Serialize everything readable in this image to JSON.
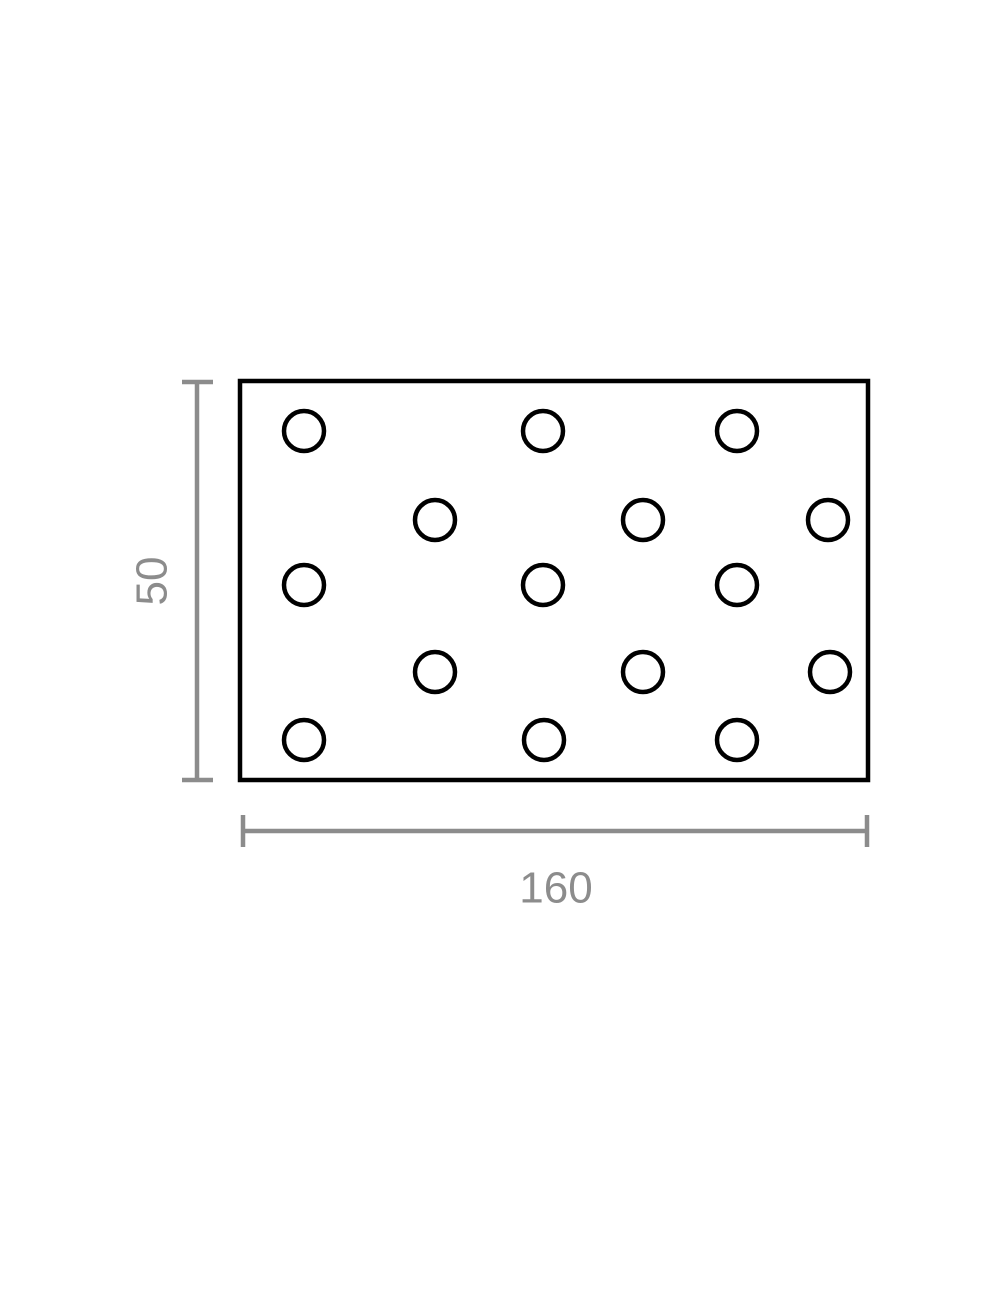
{
  "diagram": {
    "type": "technical-drawing",
    "subject": "perforated-plate-with-staggered-holes",
    "plate": {
      "outline_color": "#000000",
      "fill_color": "#ffffff",
      "stroke_width": 4.5
    },
    "holes": {
      "count": 15,
      "radius": 20,
      "stroke_width": 4.5,
      "color": "#000000",
      "centers": [
        [
          304,
          431
        ],
        [
          543,
          431
        ],
        [
          737,
          431
        ],
        [
          435,
          520
        ],
        [
          643,
          520
        ],
        [
          828,
          520
        ],
        [
          304,
          585
        ],
        [
          543,
          585
        ],
        [
          737,
          585
        ],
        [
          435,
          672
        ],
        [
          643,
          672
        ],
        [
          830,
          672
        ],
        [
          304,
          740
        ],
        [
          544,
          740
        ],
        [
          737,
          740
        ]
      ]
    },
    "dimensions": {
      "color": "#8c8c8c",
      "height": {
        "label": "50",
        "value": 50
      },
      "width": {
        "label": "160",
        "value": 160
      }
    }
  }
}
